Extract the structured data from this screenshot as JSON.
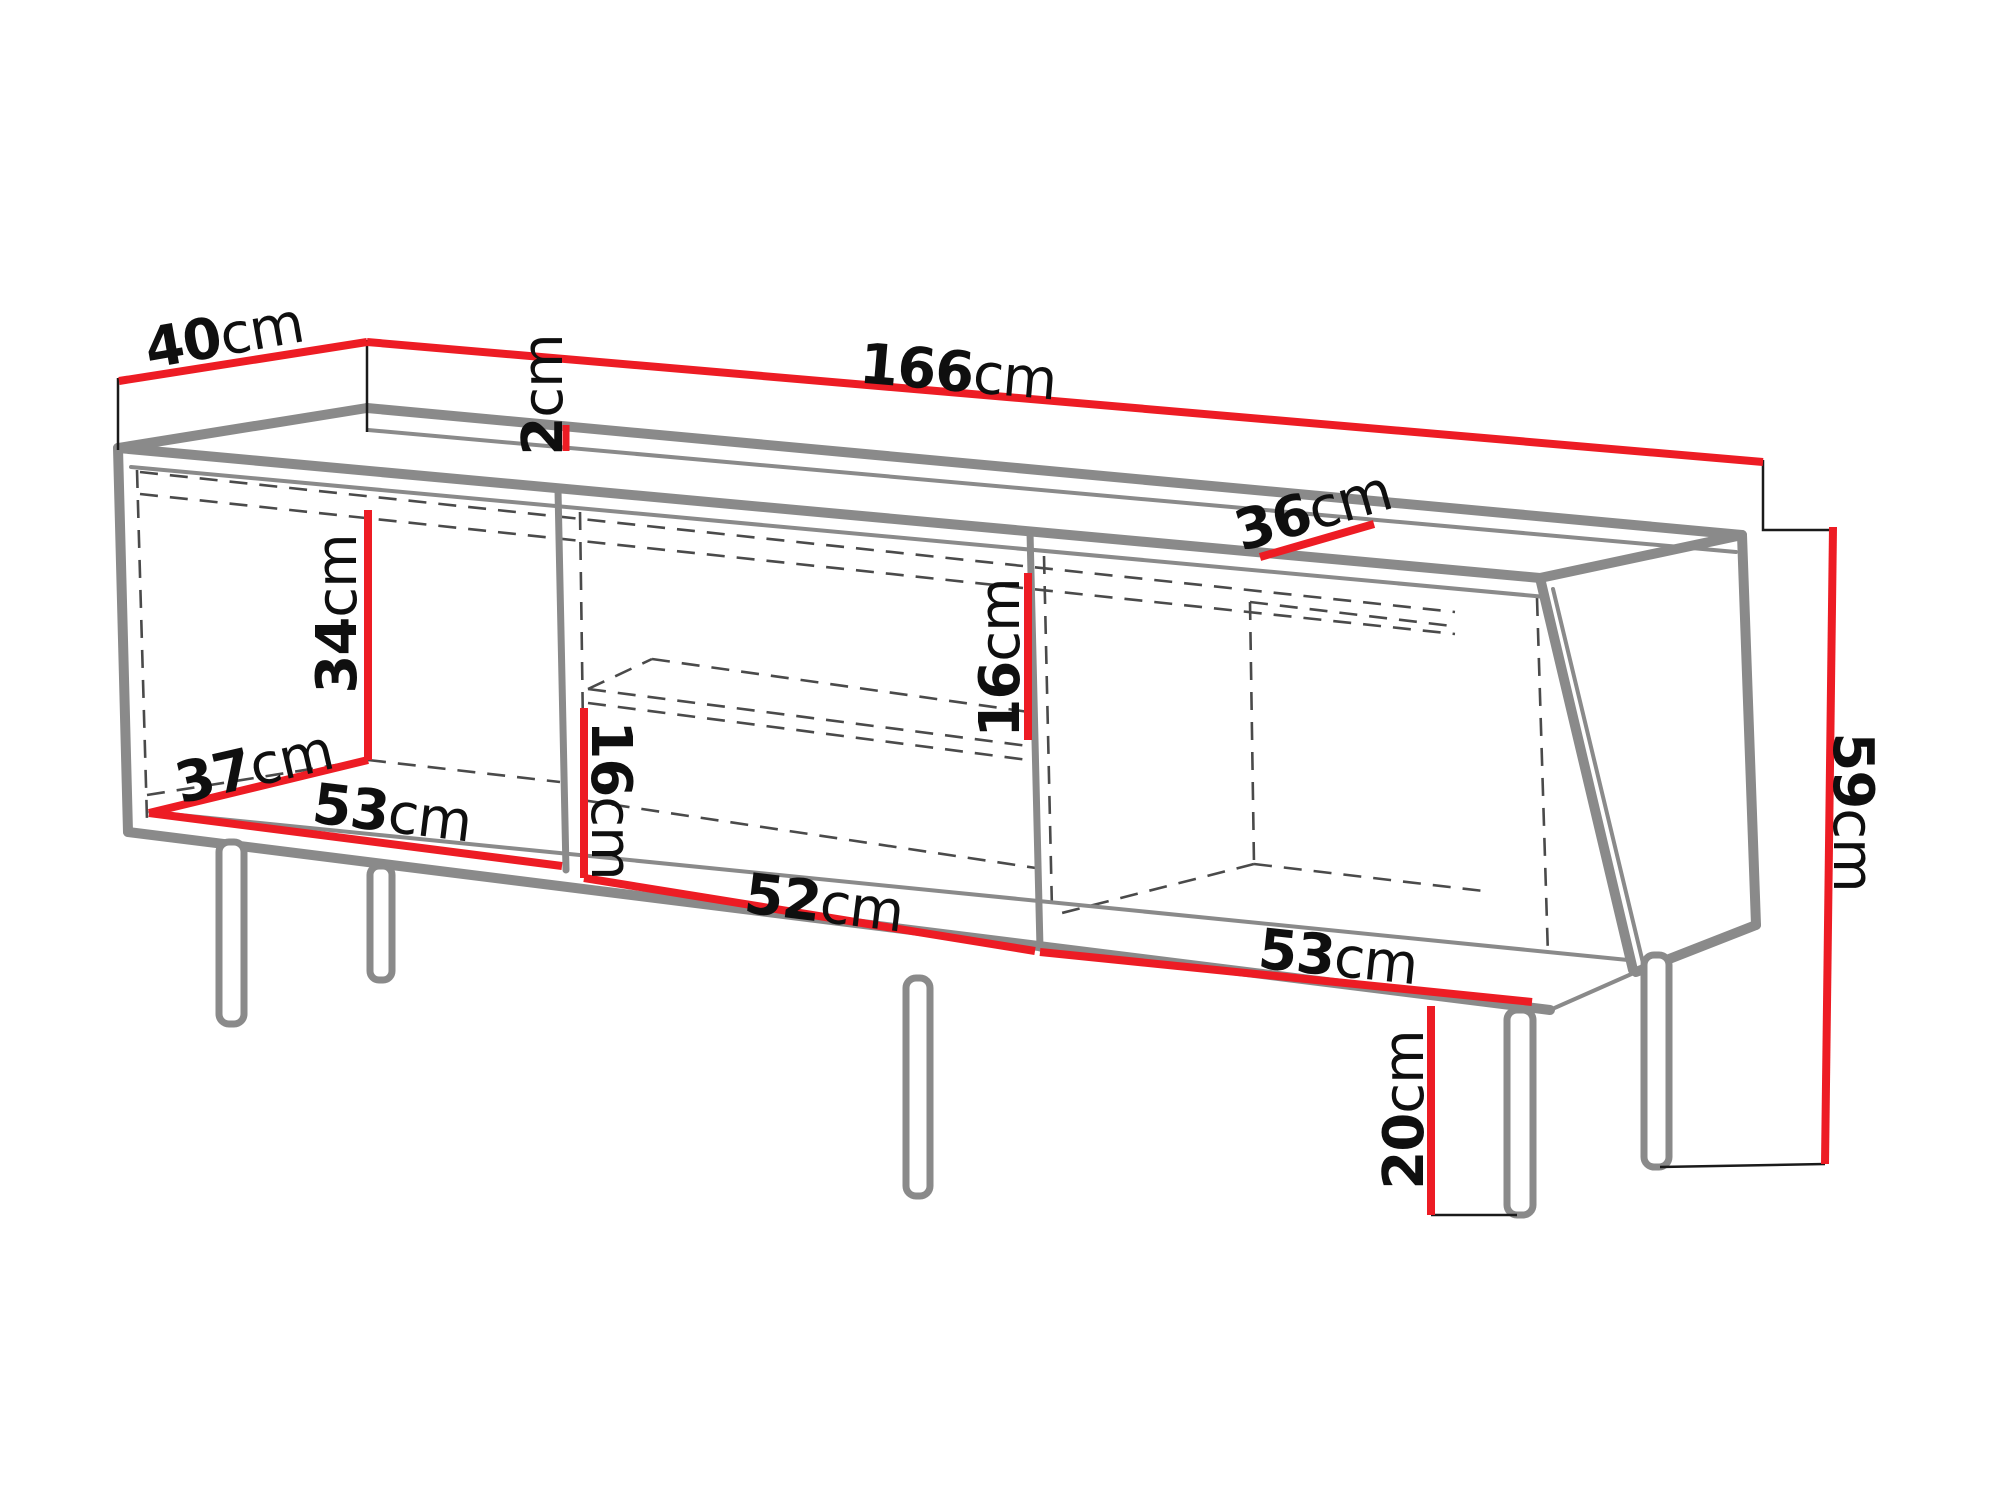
{
  "page": {
    "background": "#ffffff",
    "kind": "furniture dimension diagram",
    "subject": "TV stand sideboard with three open compartments, middle shelf and five metal legs, annotated with centimetre dimensions"
  },
  "colors": {
    "dimension_red": "#ed1c24",
    "cabinet_grey": "#8a8a8a",
    "hidden_edge_grey": "#4a4a4a",
    "extension_black": "#1a1a1a",
    "label_black": "#0f0f0f"
  },
  "unit": "cm",
  "diagram": {
    "labels": [
      {
        "id": "top-depth",
        "value": "40",
        "unit": "cm",
        "x": 224,
        "y": 336,
        "rotate": -10,
        "meaning": "top panel depth"
      },
      {
        "id": "top-thickness",
        "value": "2",
        "unit": "cm",
        "x": 543,
        "y": 395,
        "rotate": -90,
        "meaning": "top panel thickness"
      },
      {
        "id": "total-width",
        "value": "166",
        "unit": "cm",
        "x": 958,
        "y": 372,
        "rotate": 5,
        "meaning": "overall width"
      },
      {
        "id": "top-inner-depth",
        "value": "36",
        "unit": "cm",
        "x": 1313,
        "y": 511,
        "rotate": -16,
        "meaning": "top inner depth"
      },
      {
        "id": "left-compartment-height",
        "value": "34",
        "unit": "cm",
        "x": 337,
        "y": 614,
        "rotate": -90,
        "meaning": "left compartment interior height"
      },
      {
        "id": "interior-depth",
        "value": "37",
        "unit": "cm",
        "x": 254,
        "y": 767,
        "rotate": -13,
        "meaning": "interior depth"
      },
      {
        "id": "left-compartment-width",
        "value": "53",
        "unit": "cm",
        "x": 392,
        "y": 813,
        "rotate": 7,
        "meaning": "left compartment interior width"
      },
      {
        "id": "middle-lower-height",
        "value": "16",
        "unit": "cm",
        "x": 611,
        "y": 800,
        "rotate": 90,
        "meaning": "middle compartment lower opening height"
      },
      {
        "id": "middle-width",
        "value": "52",
        "unit": "cm",
        "x": 824,
        "y": 903,
        "rotate": 7,
        "meaning": "middle compartment interior width"
      },
      {
        "id": "middle-upper-height",
        "value": "16",
        "unit": "cm",
        "x": 1000,
        "y": 658,
        "rotate": -90,
        "meaning": "middle compartment upper opening height"
      },
      {
        "id": "right-compartment-width",
        "value": "53",
        "unit": "cm",
        "x": 1338,
        "y": 957,
        "rotate": 6,
        "meaning": "right compartment interior width"
      },
      {
        "id": "body-height",
        "value": "59",
        "unit": "cm",
        "x": 1853,
        "y": 812,
        "rotate": 90,
        "meaning": "cabinet body height"
      },
      {
        "id": "leg-height",
        "value": "20",
        "unit": "cm",
        "x": 1404,
        "y": 1110,
        "rotate": -90,
        "meaning": "leg height"
      }
    ],
    "legs_visible": 5
  }
}
